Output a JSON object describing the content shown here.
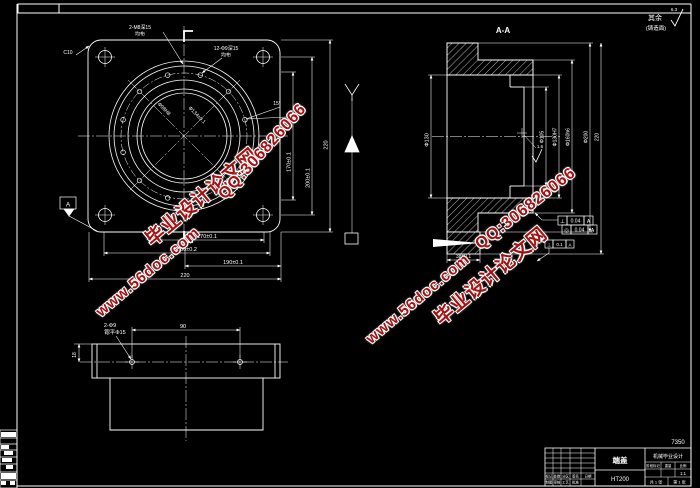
{
  "watermark": {
    "site": "www.56doc.com",
    "name": "毕业设计论文网",
    "qq": "QQ:306826066",
    "color": "#a31212"
  },
  "corner_note": {
    "qiyu": "其余",
    "rough": "6.3",
    "cast": "(铸造面)"
  },
  "front": {
    "tap_label1": "2-M8深15",
    "tap_label2": "均布",
    "hole_label1": "12-Φ9深15",
    "hole_label2": "均布",
    "chamfer": "C10",
    "angle": "15°",
    "datum": "A",
    "bore_dim": "Φ98H8",
    "ring_dim": "Φ134±0.1",
    "dims_bottom": [
      "170±0.1",
      "200±0.2",
      "190±0.1",
      "220"
    ],
    "dims_right": [
      "170±0.1",
      "200±0.1",
      "220"
    ]
  },
  "section": {
    "title": "A-A",
    "dim_left": "Φ130",
    "dims_right": [
      "Φ105",
      "Φ130H7",
      "Φ160h6",
      "Φ200",
      "220"
    ],
    "dim_bottom": "38±0.1",
    "rough1": "1.6",
    "tol": [
      {
        "sym": "⊥",
        "val": "0.04",
        "ref": "A"
      },
      {
        "sym": "◎",
        "val": "0.04",
        "ref": "A"
      },
      {
        "sym": "⊥",
        "val": "0.1",
        "ref": "A"
      }
    ]
  },
  "bottom_view": {
    "hole_label1": "2-Φ9",
    "hole_label2": "锪平Φ15",
    "dim_span": "90",
    "dim_edge": "18"
  },
  "part_no": "7350",
  "titleblock": {
    "name": "端盖",
    "material": "HT200",
    "company": "机械毕业设计",
    "rows": {
      "mark": "标记",
      "count": "处数",
      "zone": "分区",
      "sign": "签名",
      "date": "日期",
      "design": "制图",
      "check": "审核",
      "process": "工艺",
      "approve": "批准"
    },
    "right": {
      "stage": "阶段标记",
      "weight": "重量",
      "scale": "比例",
      "scale_val": "1:1",
      "sheets": "共 1 张",
      "sheet": "第 1 张"
    }
  }
}
